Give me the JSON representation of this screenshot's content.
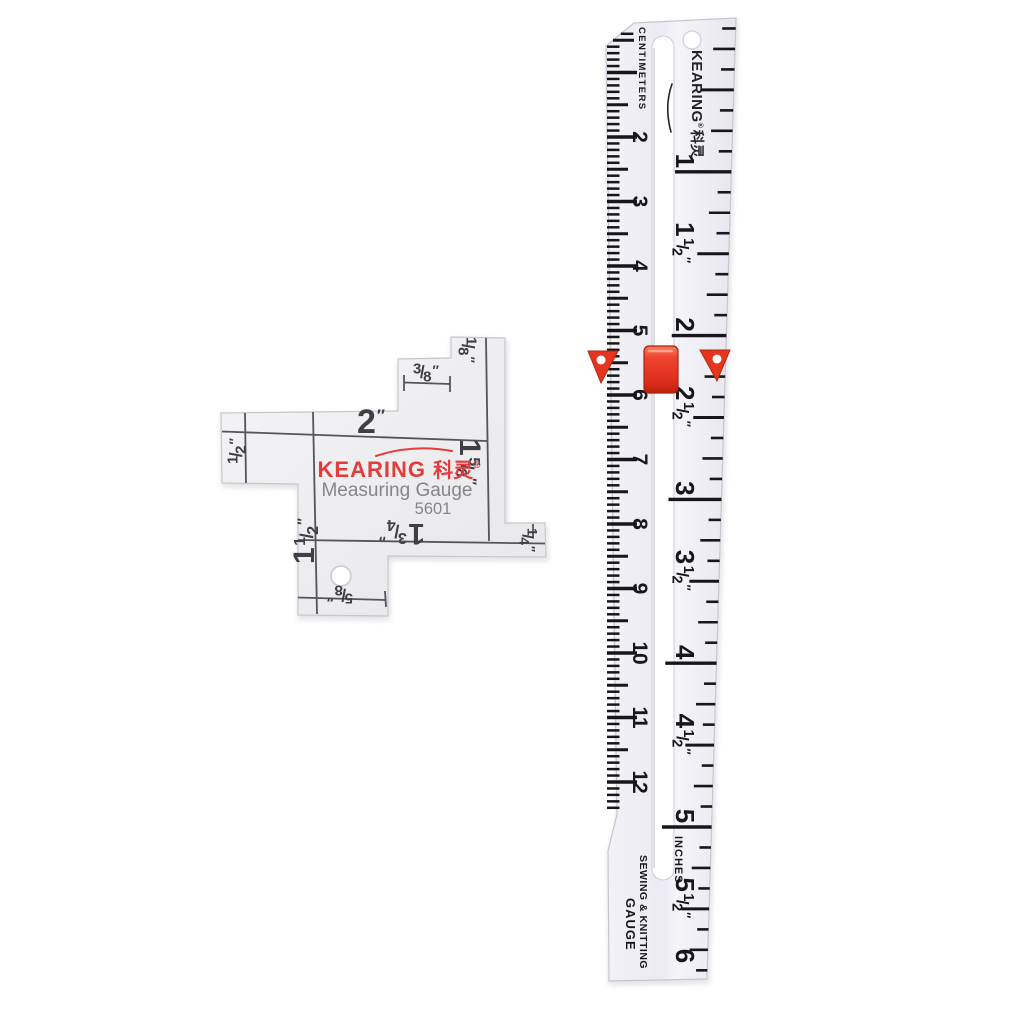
{
  "scene": {
    "background": "#ffffff",
    "description_objects": [
      "measuring-gauge-plate",
      "sewing-knitting-gauge-ruler"
    ]
  },
  "gauge": {
    "brand_latin": "KEARING",
    "brand_cjk": "科灵",
    "registered_mark": "®",
    "subtitle": "Measuring Gauge",
    "model": "5601",
    "measurements": {
      "top": {
        "display": "2″",
        "whole": "2"
      },
      "top_step": {
        "display": "3/8″",
        "num": "3",
        "den": "8"
      },
      "corner_top_right": {
        "display": "1/8″",
        "num": "1",
        "den": "8"
      },
      "left_arm": {
        "display": "1/2″",
        "num": "1",
        "den": "2"
      },
      "left_long": {
        "display": "1 1/2″",
        "whole": "1",
        "num": "1",
        "den": "2"
      },
      "right": {
        "display": "1 5/8″",
        "whole": "1",
        "num": "5",
        "den": "8"
      },
      "bottom": {
        "display": "1 3/4″",
        "whole": "1",
        "num": "3",
        "den": "4"
      },
      "bottom_arm": {
        "display": "5/8″",
        "num": "5",
        "den": "8"
      },
      "corner_bottom_right": {
        "display": "1/4″",
        "num": "1",
        "den": "4"
      }
    },
    "colors": {
      "brand_red": "#e23c3c",
      "text_gray": "#85858b",
      "line": "#54545a",
      "plate_light": "#f4f4f6",
      "plate_dark": "#e7e7ea"
    }
  },
  "ruler": {
    "brand_latin": "KEARING",
    "registered_mark": "®",
    "brand_cjk": "科灵",
    "scale_left_title": "CENTIMETERS",
    "scale_right_title": "INCHES",
    "footer_line1": "SEWING & KNITTING",
    "footer_line2": "GAUGE",
    "cm_numbers": [
      "2",
      "3",
      "4",
      "5",
      "6",
      "7",
      "8",
      "9",
      "10",
      "11",
      "12"
    ],
    "inch_labels": [
      {
        "display": "1",
        "whole": "1"
      },
      {
        "display": "1 1/2",
        "whole": "1",
        "num": "1",
        "den": "2"
      },
      {
        "display": "2",
        "whole": "2"
      },
      {
        "display": "2 1/2",
        "whole": "2",
        "num": "1",
        "den": "2"
      },
      {
        "display": "3",
        "whole": "3"
      },
      {
        "display": "3 1/2",
        "whole": "3",
        "num": "1",
        "den": "2"
      },
      {
        "display": "4",
        "whole": "4"
      },
      {
        "display": "4 1/2",
        "whole": "4",
        "num": "1",
        "den": "2"
      },
      {
        "display": "5",
        "whole": "5"
      },
      {
        "display": "5 1/2",
        "whole": "5",
        "num": "1",
        "den": "2"
      },
      {
        "display": "6",
        "whole": "6"
      }
    ],
    "slider": {
      "color": "#e8432e",
      "position_cm": 5.7,
      "position_inch": 2.25
    },
    "colors": {
      "body_light": "#f2f2f6",
      "body_dark": "#e6e6ed",
      "tick": "#17171b",
      "brand_dark": "#23232d"
    }
  }
}
